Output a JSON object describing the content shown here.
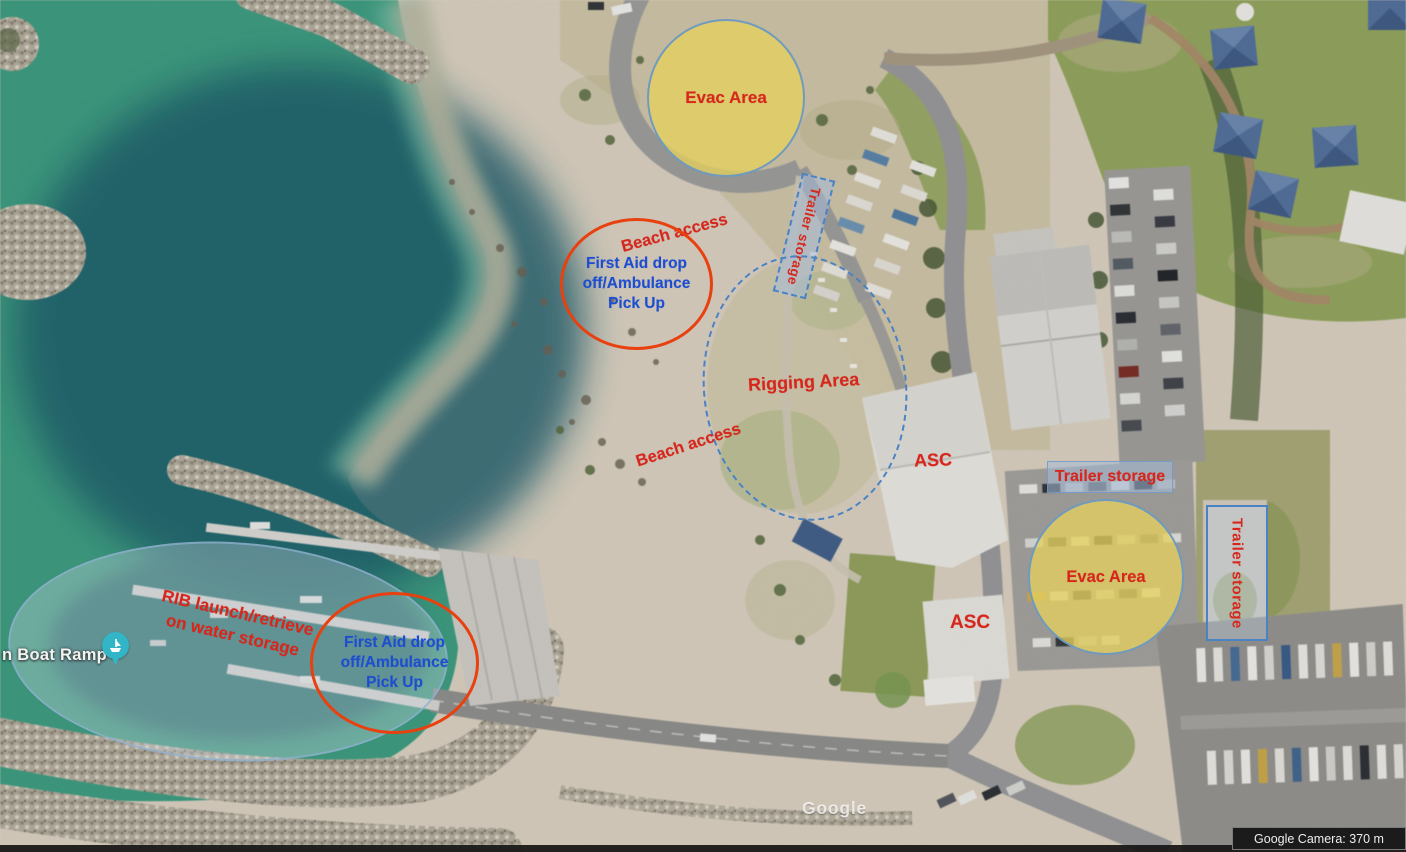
{
  "theme": {
    "label_red": "#d7271d",
    "label_blue": "#1d4ed2",
    "evac_fill": "rgba(228,208,94,0.78)",
    "evac_stroke": "rgba(100,150,200,0.9)",
    "first_aid_stroke": "#e8400f",
    "zone_stroke": "#4a82c4",
    "storage_fill": "rgba(165,188,216,0.55)"
  },
  "annotations": {
    "evac_area_north": {
      "label": "Evac Area"
    },
    "evac_area_south": {
      "label": "Evac Area"
    },
    "beach_access_north": {
      "label": "Beach access"
    },
    "beach_access_south": {
      "label": "Beach access"
    },
    "first_aid_north": {
      "label": "First Aid drop\noff/Ambulance\nPick Up"
    },
    "first_aid_south": {
      "label": "First Aid drop\noff/Ambulance\nPick Up"
    },
    "trailer_storage_north": {
      "label": "Trailer storage"
    },
    "trailer_storage_east": {
      "label": "Trailer storage"
    },
    "trailer_storage_far_east": {
      "label": "Trailer storage"
    },
    "rigging_area": {
      "label": "Rigging Area"
    },
    "asc_north": {
      "label": "ASC"
    },
    "asc_south": {
      "label": "ASC"
    },
    "rib_storage": {
      "label": "RIB launch/retrieve\non water storage"
    }
  },
  "map_labels": {
    "boat_ramp": "n Boat Ramp"
  },
  "attribution": {
    "watermark": "Google",
    "camera_readout": "Google Camera: 370 m"
  }
}
